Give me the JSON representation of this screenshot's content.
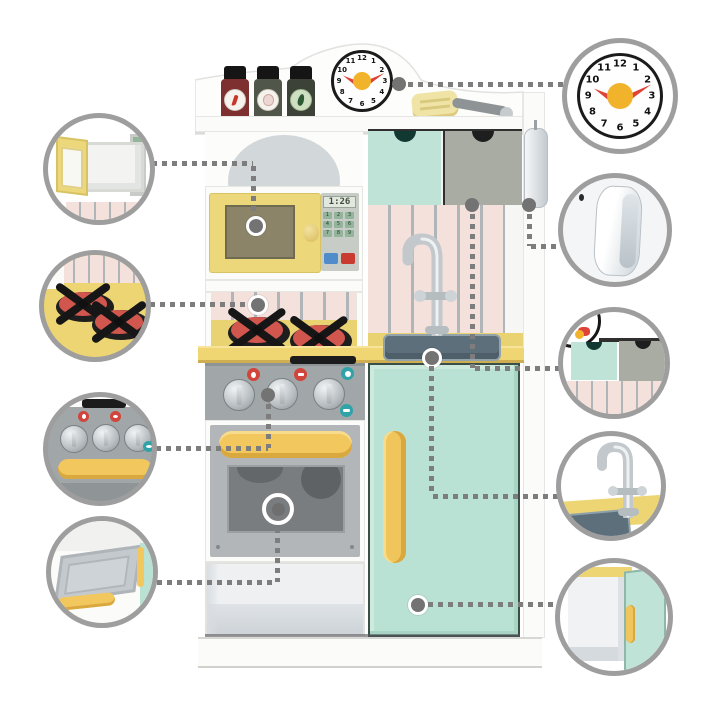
{
  "meta": {
    "canvas_w": 720,
    "canvas_h": 720,
    "subject": "toy-play-kitchen-feature-callouts"
  },
  "colors": {
    "mint": "#bce2d5",
    "mint_dark": "#8fb7a8",
    "yellow_door": "#ecd87b",
    "yellow_handle": "#f2c75e",
    "yellow_counter": "#ecd271",
    "pink_wall": "#f4e1dc",
    "wall_stripe": "#b0b5b8",
    "panel_gray": "#a1a6a8",
    "oven_door_gray": "#b2b6b8",
    "oven_window": "#797d7f",
    "drawer_gray": "#a9aca2",
    "sink_basin": "#5d6f7b",
    "accent_red": "#d0453c",
    "accent_teal": "#2fa3a8",
    "clock_hand_red": "#df4337",
    "clock_center_yellow": "#f2b32c",
    "connector_gray": "#7d7d7d",
    "callout_ring_gray": "#9e9e9e",
    "silver": "#c6cbce"
  },
  "kitchen": {
    "clock": {
      "numerals": [
        "12",
        "1",
        "2",
        "3",
        "4",
        "5",
        "6",
        "7",
        "8",
        "9",
        "10",
        "11"
      ],
      "hour_hand_points_to": "10",
      "minute_hand_points_to": "2"
    },
    "shelf_items": {
      "spice_jars": [
        {
          "icon": "chili-jar-icon"
        },
        {
          "icon": "garlic-jar-icon"
        },
        {
          "icon": "herb-jar-icon"
        }
      ],
      "utensil_icon": "spatula-icon"
    },
    "drawers": [
      {
        "color_name": "mint"
      },
      {
        "color_name": "gray"
      }
    ],
    "microwave": {
      "display": "1:26",
      "keypad": [
        [
          "1",
          "2",
          "3"
        ],
        [
          "4",
          "5",
          "6"
        ],
        [
          "7",
          "8",
          "9"
        ]
      ],
      "action_buttons": [
        {
          "icon": "start-button-blue"
        },
        {
          "icon": "stop-button-red"
        }
      ]
    },
    "stove": {
      "burner_count": "2"
    },
    "control_panel": {
      "knob_count": "3"
    }
  },
  "callouts": {
    "left": [
      {
        "id": "microwave-door-open"
      },
      {
        "id": "stove-burners"
      },
      {
        "id": "control-knobs"
      },
      {
        "id": "oven-door-open"
      }
    ],
    "right": [
      {
        "id": "teaching-clock"
      },
      {
        "id": "side-phone"
      },
      {
        "id": "storage-drawers"
      },
      {
        "id": "sink-faucet"
      },
      {
        "id": "fridge-door-open"
      }
    ]
  }
}
